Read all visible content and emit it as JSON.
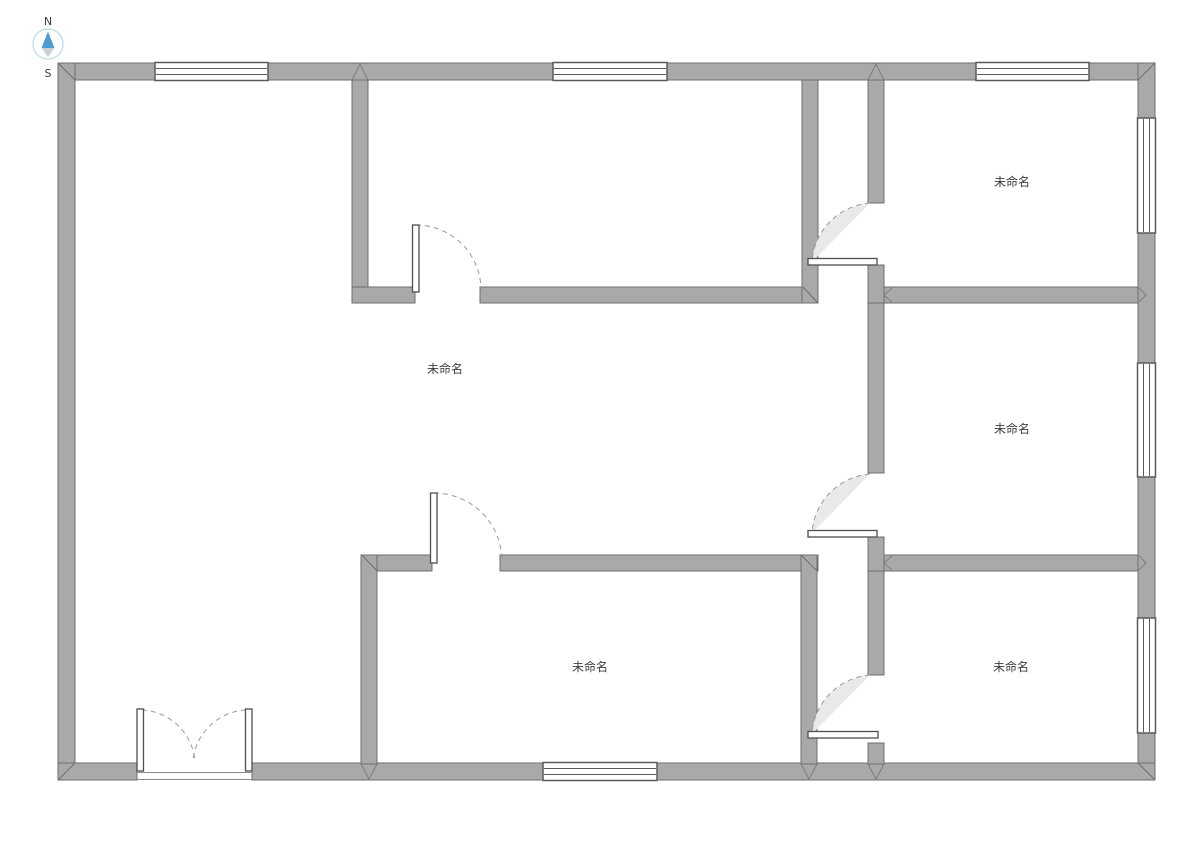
{
  "canvas": {
    "width": 1191,
    "height": 842,
    "background": "#ffffff"
  },
  "compass": {
    "north_label": "N",
    "south_label": "S",
    "needle_color": "#4e9bcd",
    "needle_tail_color": "#c9ced3",
    "ring_color": "#b9d9ec"
  },
  "rooms": [
    {
      "name": "room-center",
      "label": "未命名"
    },
    {
      "name": "room-top-right",
      "label": "未命名"
    },
    {
      "name": "room-middle-right",
      "label": "未命名"
    },
    {
      "name": "room-bottom-middle",
      "label": "未命名"
    },
    {
      "name": "room-bottom-right",
      "label": "未命名"
    }
  ],
  "palette": {
    "wall_fill": "#a9a9a9",
    "wall_stroke": "#6e6e6e",
    "window_stroke": "#5a5a5a",
    "door_leaf_stroke": "#4f4f4f",
    "door_swing_fill": "#e9e9e9",
    "door_arc_stroke": "#9a9a9a",
    "label_color": "#3d3d3d"
  },
  "inventory": {
    "windows": 7,
    "single_doors": 5,
    "double_doors": 1
  }
}
